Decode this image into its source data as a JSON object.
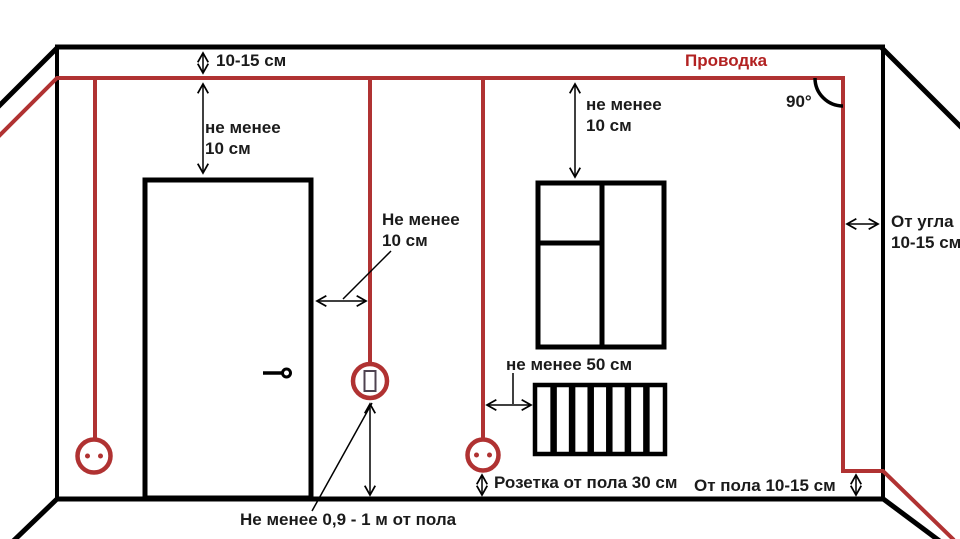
{
  "colors": {
    "wire_red": "#b03232",
    "label_red": "#b22222",
    "line_black": "#000000",
    "text_black": "#1b1b1b"
  },
  "labels": {
    "wiring_title": "Проводка",
    "right_angle": "90°",
    "ceiling_gap": "10-15 см",
    "door_top": {
      "line1": "не менее",
      "line2": "10 см"
    },
    "window_top": {
      "line1": "не менее",
      "line2": "10 см"
    },
    "switch_gap": {
      "line1": "Не менее",
      "line2": "10 см"
    },
    "corner_gap": {
      "line1": "От угла",
      "line2": "10-15 см"
    },
    "radiator_gap": "не менее 50 см",
    "socket_height": "Розетка от пола 30 см",
    "floor_gap": "От пола 10-15 см",
    "switch_height": "Не менее 0,9 - 1 м от пола"
  }
}
